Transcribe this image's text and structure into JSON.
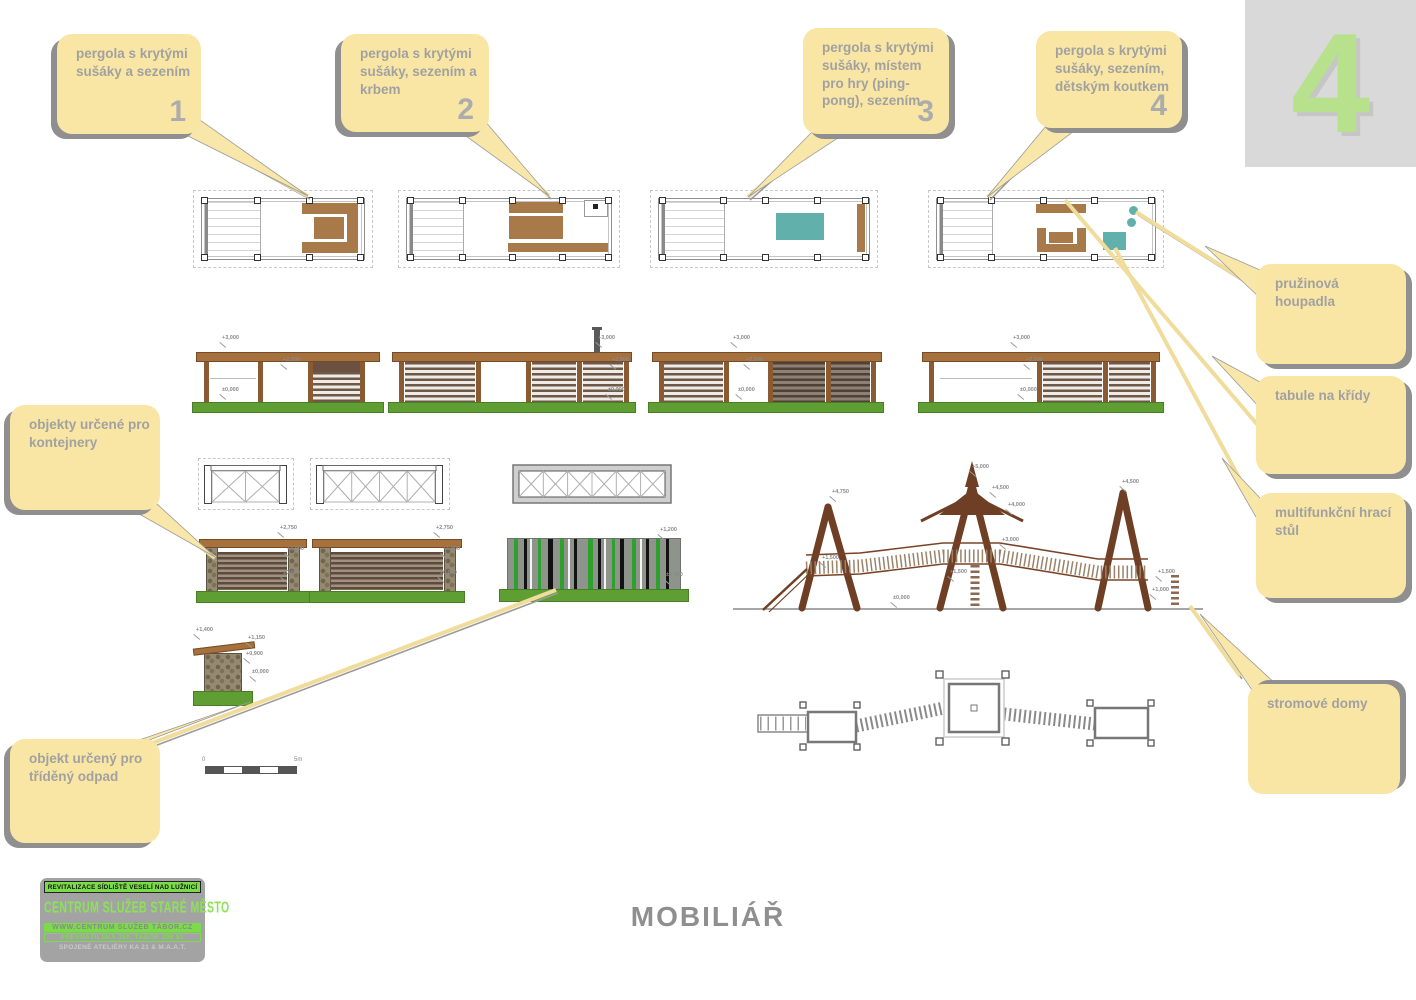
{
  "sheet": {
    "number": "4",
    "title": "MOBILIÁŘ"
  },
  "callouts": {
    "pergola1": {
      "text": "pergola s krytými sušáky a sezením",
      "number": "1"
    },
    "pergola2": {
      "text": "pergola s krytými sušáky, sezením a krbem",
      "number": "2"
    },
    "pergola3": {
      "text": "pergola s krytými sušáky, místem pro hry (ping-pong), sezením",
      "number": "3"
    },
    "pergola4": {
      "text": "pergola s krytými sušáky, sezením, dětským koutkem",
      "number": "4"
    },
    "spring_riders": {
      "text": "pružinová houpadla"
    },
    "chalkboards": {
      "text": "tabule na křídy"
    },
    "game_table": {
      "text": "multifunkční hrací stůl"
    },
    "tree_houses": {
      "text": "stromové domy"
    },
    "containers": {
      "text": "objekty určené pro kontejnery"
    },
    "sorted_waste": {
      "text": "objekt určený pro tříděný odpad"
    }
  },
  "titleblock": {
    "line1": "REVITALIZACE SÍDLIŠTĚ VESELÍ NAD LUŽNICÍ",
    "line2": "CENTRUM SLUŽEB STARÉ MĚSTO",
    "line3": "WWW.CENTRUM SLUŽEB TÁBOR.CZ",
    "line4": "PŘEVRÁTILSKÁ 330, TÁBOR 390 01",
    "line5": "SPOJENÉ ATELIÉRY KA 21 & M.A.A.T."
  },
  "scalebar": {
    "zero": "0",
    "five": "5m"
  },
  "dims": {
    "p5000": "+5,000",
    "p4750": "+4,750",
    "p4500": "+4,500",
    "p4000": "+4,000",
    "p3000": "+3,000",
    "p2750": "+2,750",
    "p2500": "+2,500",
    "p1500": "+1,500",
    "p1400": "+1,400",
    "p1200": "+1,200",
    "p1150": "+1,150",
    "p1000": "+1,000",
    "p0900": "+0,900",
    "zero": "±0,000"
  },
  "colors": {
    "callout_bg": "#f9e6a4",
    "accent_green": "#b7e18d",
    "wood": "#a5713d",
    "wood_dark": "#6b5240",
    "ground_green": "#5f9e33",
    "teal": "#62b0ac",
    "logo_green": "#7bdc4a"
  }
}
